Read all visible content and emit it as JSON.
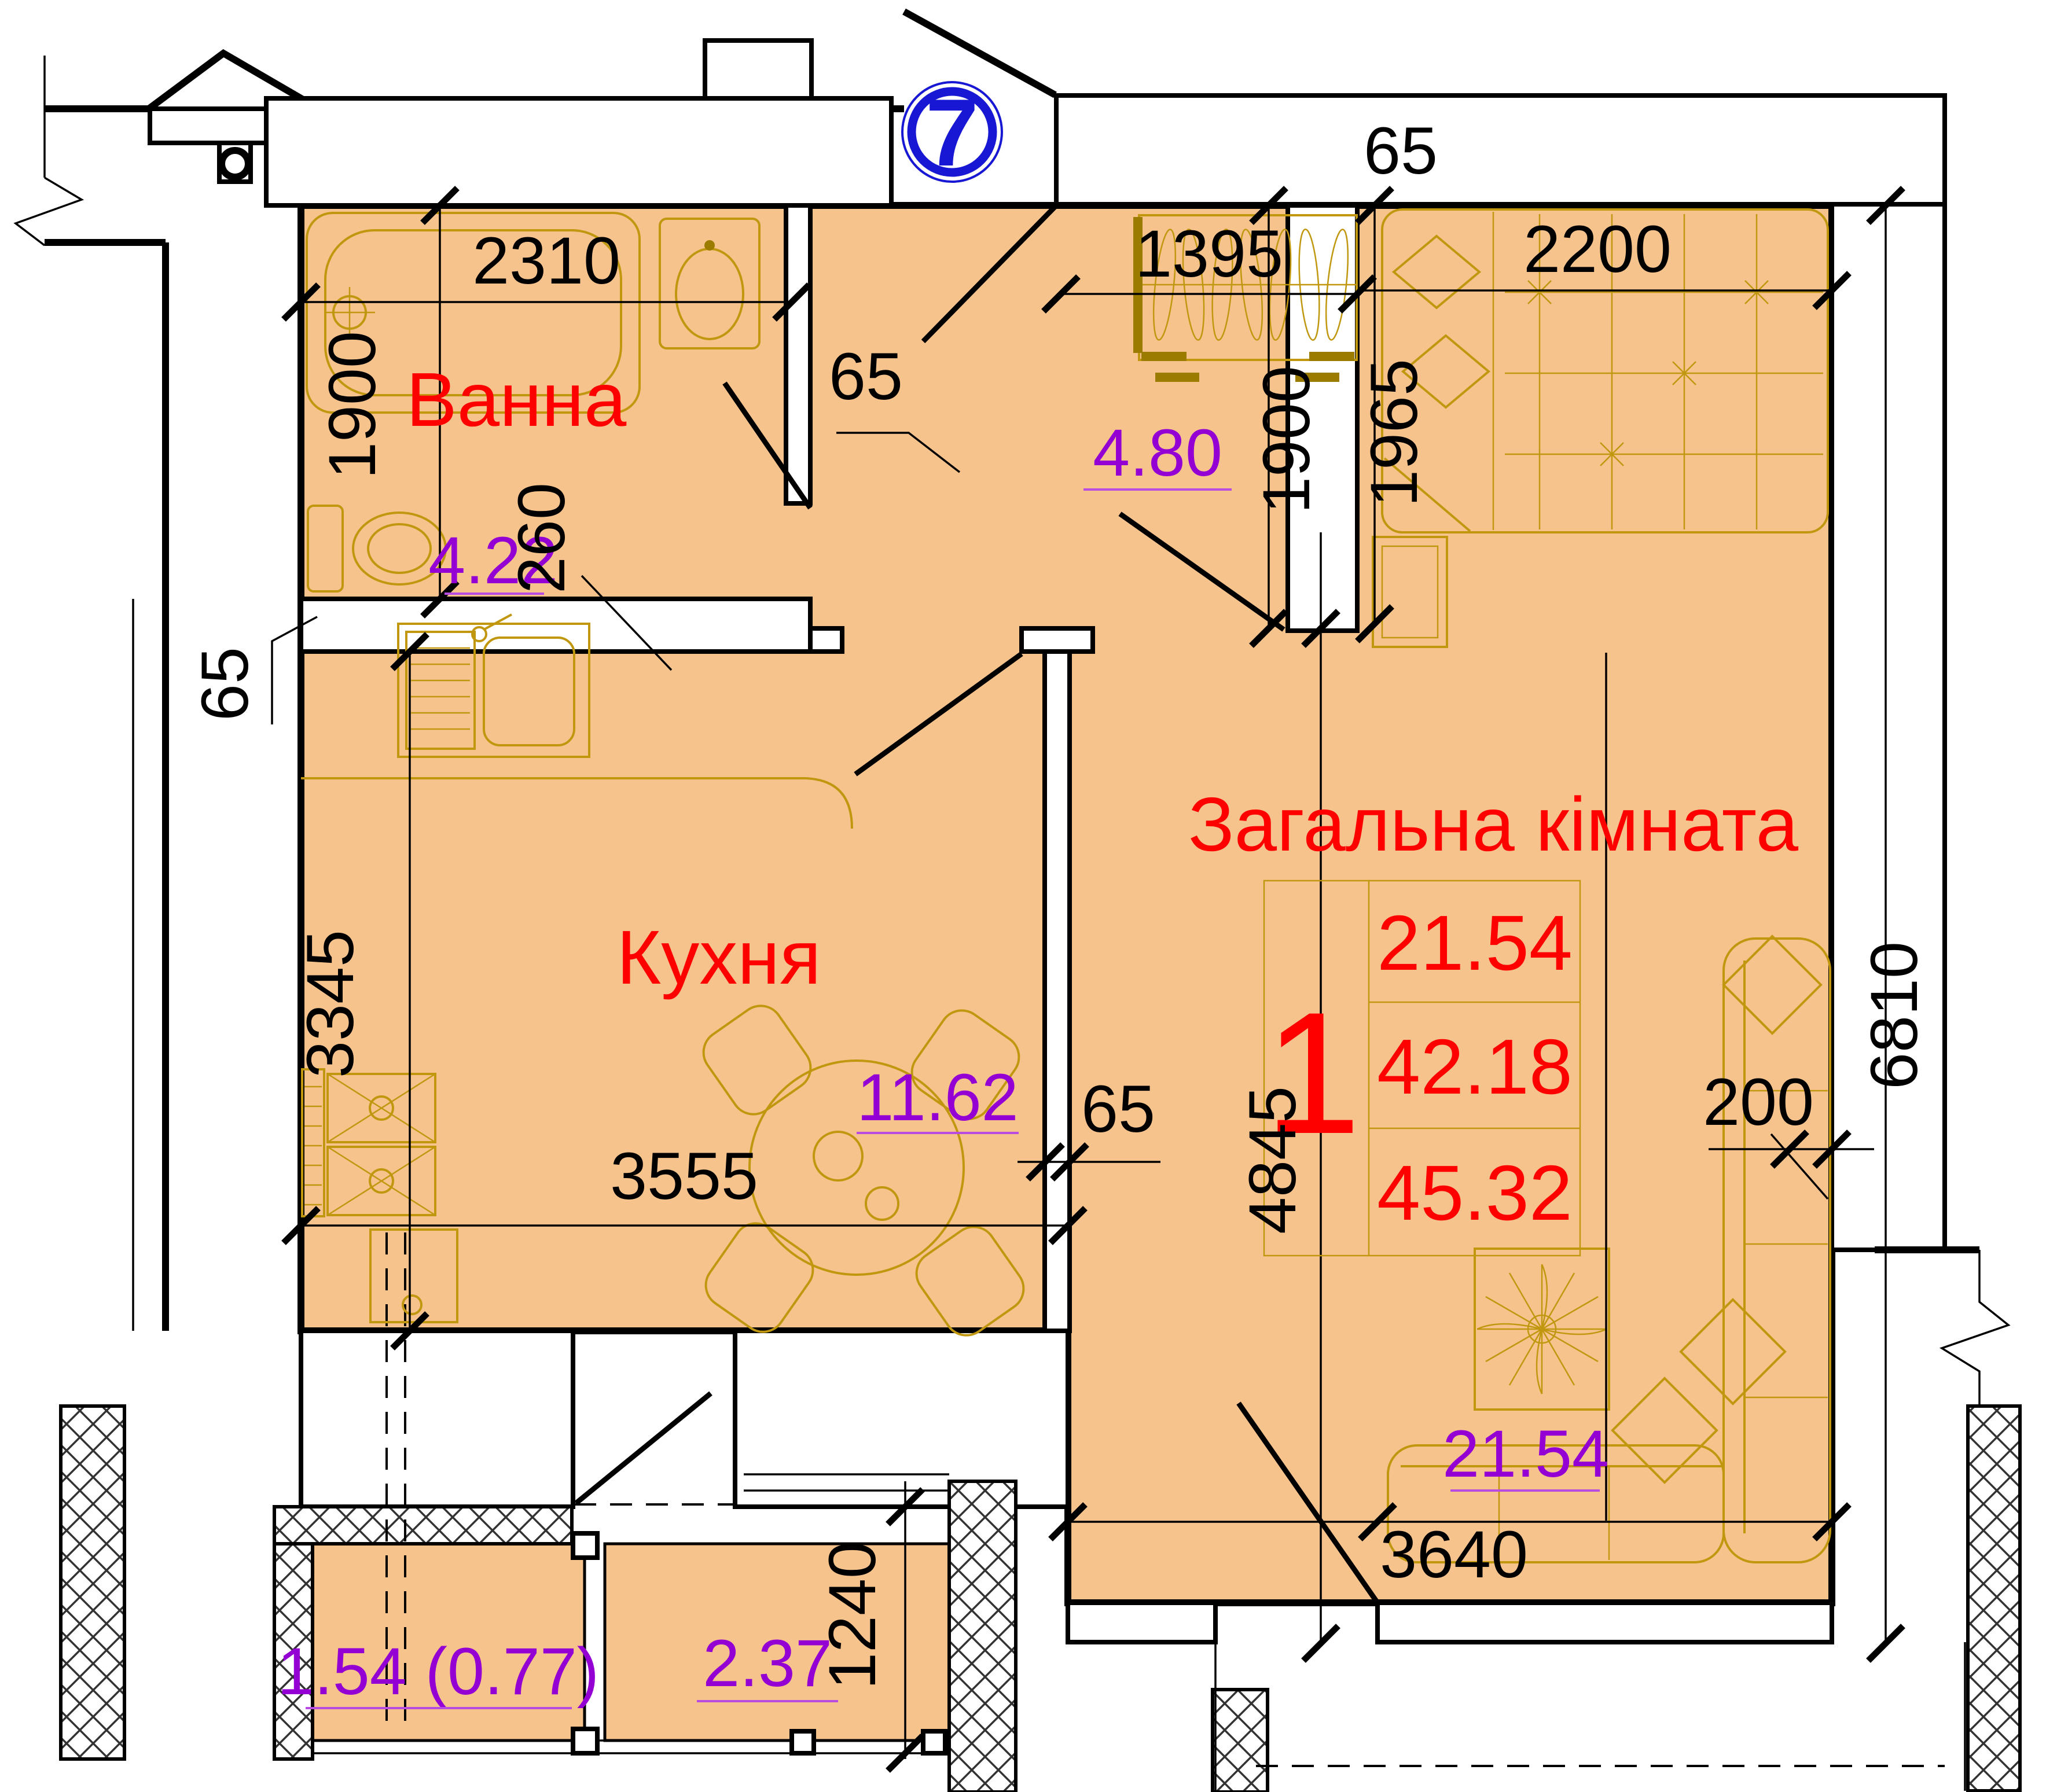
{
  "plan": {
    "apartment_number": "7",
    "rooms": {
      "bathroom": {
        "name": "Ванна",
        "area": "4.22"
      },
      "hall": {
        "area": "4.80"
      },
      "kitchen": {
        "name": "Кухня",
        "area": "11.62"
      },
      "living": {
        "name": "Загальна кімната",
        "area": "21.54"
      },
      "balcony_left": {
        "area": "1.54 (0.77)"
      },
      "balcony_right": {
        "area": "2.37"
      }
    },
    "area_table": {
      "number": "1",
      "living_area": "21.54",
      "apartment_area": "42.18",
      "total_area": "45.32"
    },
    "dimensions": {
      "top_wall": "65",
      "bath_width": "2310",
      "bath_height": "1900",
      "bath_door": "260",
      "hall_wall": "65",
      "wardrobe_width": "1395",
      "hall_height": "1900",
      "bed_width": "2200",
      "bed_height": "1965",
      "left_wall": "65",
      "kitchen_height": "3345",
      "kitchen_width": "3555",
      "mid_wall": "65",
      "living_height": "4845",
      "total_height": "6810",
      "sofa_offset": "200",
      "living_width": "3640",
      "balcony_height": "1240"
    },
    "colors": {
      "floor": "#F7C38D",
      "room_label": "#FF0000",
      "area_label": "#9400D3",
      "marker": "#1717D4",
      "furniture": "#C0970E"
    }
  }
}
